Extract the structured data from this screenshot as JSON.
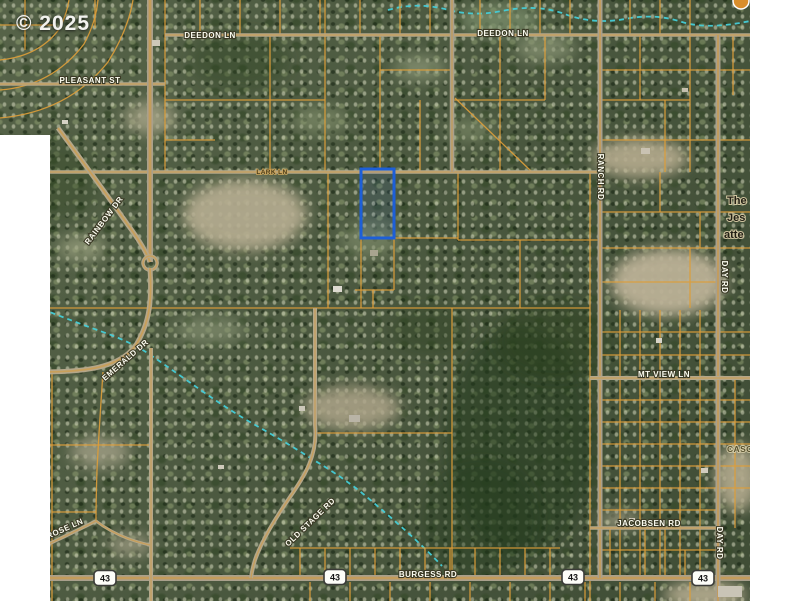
{
  "copyright": "© 2025",
  "map": {
    "palette": {
      "parcel_line": "#dc9d3a",
      "road_casing_tan": "#b4a78a",
      "road_casing_gray": "#a9a08c",
      "road_core_orange": "#d59a3a",
      "creek": "#45cdd8",
      "highlight_blue": "#1d5fd8",
      "label_white": "#fcfcf0",
      "white_margin": "#ffffff"
    },
    "parcel_highlight": {
      "x": 361,
      "y": 169,
      "w": 33,
      "h": 69
    },
    "badge": {
      "cx": 741,
      "cy": 1,
      "r": 8,
      "fill": "#d98e2c"
    },
    "roads_major": [
      {
        "name": "deedon-ln-road",
        "d": "M165,35 H750",
        "w": 3.5
      },
      {
        "name": "pleasant-st-road",
        "d": "M0,84 H165",
        "w": 3.5
      },
      {
        "name": "lark-ln-road",
        "d": "M40,172 H600",
        "w": 3.5
      },
      {
        "name": "burgess-rd-road",
        "d": "M40,578 H750",
        "w": 6,
        "g": 1
      },
      {
        "name": "ranch-rd-road",
        "d": "M600,0 V578",
        "w": 5,
        "g": 1
      },
      {
        "name": "day-rd-road",
        "d": "M718,35 V601",
        "w": 5,
        "g": 1
      },
      {
        "name": "west-vertical-road",
        "d": "M150,0 V262",
        "w": 6,
        "g": 1
      },
      {
        "name": "north-vertical-road",
        "d": "M452,0 V172",
        "w": 4.5,
        "g": 1
      },
      {
        "name": "mt-view-ln-road",
        "d": "M590,378 H750",
        "w": 4
      },
      {
        "name": "jacobsen-rd-road",
        "d": "M590,528 H718",
        "w": 3.5
      },
      {
        "name": "rainbow-dr-road",
        "d": "M58,128 Q100,185 128,225 Q145,248 150,262",
        "w": 5
      },
      {
        "name": "roundabout",
        "d": "M150,256 a7,7 0 1,0 0.1,0",
        "w": 3.5
      },
      {
        "name": "emerald-dr-road",
        "d": "M150,268 C152,300 150,322 136,345 C120,368 85,372 40,372",
        "w": 5
      },
      {
        "name": "south-vertical-road",
        "d": "M151,348 V601",
        "w": 4
      },
      {
        "name": "old-stage-rd-road",
        "d": "M315,308 V425 C318,455 305,475 290,497 C275,519 262,540 255,560 Q252,570 251,578",
        "w": 4
      },
      {
        "name": "rose-ln-road",
        "d": "M40,548 Q70,534 96,521",
        "w": 3.5
      },
      {
        "name": "rose-ln-east-road",
        "d": "M96,521 Q118,538 150,545",
        "w": 3
      }
    ],
    "parcel_lines": [
      "M200,0 V35",
      "M240,0 V35",
      "M280,0 V35",
      "M320,0 V35",
      "M360,0 V35",
      "M400,0 V35",
      "M430,0 V35",
      "M480,0 V35",
      "M510,0 V35",
      "M540,0 V35",
      "M570,0 V35",
      "M630,0 V35",
      "M660,0 V35",
      "M690,0 V35",
      "M25,0 V50",
      "M0,25 H55",
      "M95,0 V28",
      "M0,118 Q68,112 108,62 Q128,30 133,0",
      "M0,90 Q52,86 84,44 Q96,22 98,0",
      "M0,60 Q40,56 60,28 Q67,13 69,0",
      "M165,0 V172",
      "M270,35 V172",
      "M325,0 V172",
      "M380,35 V172",
      "M420,100 V172",
      "M500,35 V172",
      "M545,35 V100",
      "M640,35 V100",
      "M665,100 V172",
      "M690,35 V172",
      "M733,35 V95",
      "M165,100 H325",
      "M165,140 H215",
      "M380,70 H452",
      "M452,100 H545",
      "M600,70 H750",
      "M600,100 H690",
      "M600,140 H750",
      "M455,98 L532,172",
      "M328,172 V308",
      "M361,172 V308",
      "M394,172 V290",
      "M458,172 V240",
      "M520,240 V308",
      "M373,290 V308",
      "M590,172 V601",
      "M355,290 H394",
      "M394,238 H458",
      "M458,240 H600",
      "M40,308 H590",
      "M600,212 H750",
      "M600,248 H750",
      "M600,282 H718",
      "M660,172 V212",
      "M700,212 V248",
      "M690,248 V308",
      "M52,372 V601",
      "M50,445 H152",
      "M52,512 H96",
      "M103,372 Q99,430 97,470 Q96,500 96,521",
      "M452,308 V578",
      "M315,433 H452",
      "M620,310 V578",
      "M640,310 V578",
      "M660,310 V578",
      "M680,310 V578",
      "M700,310 V578",
      "M735,378 V528",
      "M600,332 H750",
      "M600,355 H750",
      "M600,400 H750",
      "M600,422 H750",
      "M600,444 H750",
      "M600,466 H750",
      "M600,488 H750",
      "M600,510 H718",
      "M600,550 H718",
      "M610,528 V578",
      "M645,528 V578",
      "M665,528 V578",
      "M685,550 V578",
      "M290,548 H560",
      "M300,548 V578",
      "M325,548 V578",
      "M350,548 V578",
      "M375,548 V578",
      "M400,548 V578",
      "M425,548 V578",
      "M450,548 V578",
      "M475,548 V578",
      "M500,548 V578",
      "M525,548 V578",
      "M550,548 V578",
      "M310,582 V601",
      "M350,582 V601",
      "M390,582 V601",
      "M430,582 V601",
      "M470,582 V601",
      "M510,582 V601",
      "M550,582 V601",
      "M585,582 V601",
      "M620,582 V601",
      "M655,582 V601",
      "M690,582 V601"
    ],
    "creeks": [
      "M388,10 Q415,2 445,9 Q472,17 502,11 Q535,4 562,13 Q592,25 625,19 Q655,13 682,22 Q708,30 750,21",
      "M42,309 Q75,322 100,331 Q132,342 152,356 Q178,374 202,391 Q232,412 257,426 Q287,443 312,459 Q341,476 362,493 Q386,513 406,531 Q428,551 442,566"
    ],
    "clearings": [
      {
        "cx": 245,
        "cy": 215,
        "rx": 62,
        "ry": 36,
        "f": "#b7ae92",
        "o": 0.9
      },
      {
        "cx": 150,
        "cy": 118,
        "rx": 26,
        "ry": 16,
        "f": "#a9a689",
        "o": 0.8
      },
      {
        "cx": 640,
        "cy": 158,
        "rx": 48,
        "ry": 20,
        "f": "#b5ab8e",
        "o": 0.9
      },
      {
        "cx": 668,
        "cy": 282,
        "rx": 58,
        "ry": 34,
        "f": "#bbb196",
        "o": 0.95
      },
      {
        "cx": 352,
        "cy": 408,
        "rx": 48,
        "ry": 22,
        "f": "#ada489",
        "o": 0.85
      },
      {
        "cx": 100,
        "cy": 452,
        "rx": 30,
        "ry": 16,
        "f": "#a3a087",
        "o": 0.8
      },
      {
        "cx": 545,
        "cy": 48,
        "rx": 30,
        "ry": 14,
        "f": "#8f9a79",
        "o": 0.7
      },
      {
        "cx": 420,
        "cy": 68,
        "rx": 26,
        "ry": 13,
        "f": "#8f9a79",
        "o": 0.7
      },
      {
        "cx": 737,
        "cy": 478,
        "rx": 22,
        "ry": 34,
        "f": "#b3aa8e",
        "o": 0.9
      },
      {
        "cx": 705,
        "cy": 595,
        "rx": 42,
        "ry": 14,
        "f": "#b7ae92",
        "o": 0.9
      },
      {
        "cx": 82,
        "cy": 248,
        "rx": 24,
        "ry": 13,
        "f": "#9aa07f",
        "o": 0.75
      },
      {
        "cx": 500,
        "cy": 20,
        "rx": 40,
        "ry": 16,
        "f": "#7f9370",
        "o": 0.7
      },
      {
        "cx": 210,
        "cy": 330,
        "rx": 35,
        "ry": 14,
        "f": "#8d9878",
        "o": 0.6
      },
      {
        "cx": 370,
        "cy": 240,
        "rx": 30,
        "ry": 18,
        "f": "#85926f",
        "o": 0.6
      },
      {
        "cx": 620,
        "cy": 520,
        "rx": 20,
        "ry": 10,
        "f": "#a8a289",
        "o": 0.7
      },
      {
        "cx": 130,
        "cy": 545,
        "rx": 22,
        "ry": 12,
        "f": "#a5a188",
        "o": 0.7
      },
      {
        "cx": 320,
        "cy": 120,
        "rx": 28,
        "ry": 14,
        "f": "#87946f",
        "o": 0.6
      },
      {
        "cx": 470,
        "cy": 130,
        "rx": 25,
        "ry": 12,
        "f": "#87946f",
        "o": 0.55
      }
    ],
    "dark_patches": [
      {
        "cx": 520,
        "cy": 440,
        "rx": 75,
        "ry": 115,
        "f": "#243a1e",
        "o": 0.5
      },
      {
        "cx": 555,
        "cy": 340,
        "rx": 60,
        "ry": 40,
        "f": "#2a401f",
        "o": 0.45
      },
      {
        "cx": 480,
        "cy": 520,
        "rx": 60,
        "ry": 60,
        "f": "#243a1e",
        "o": 0.4
      },
      {
        "cx": 240,
        "cy": 60,
        "rx": 50,
        "ry": 30,
        "f": "#2e4424",
        "o": 0.4
      },
      {
        "cx": 60,
        "cy": 180,
        "rx": 40,
        "ry": 40,
        "f": "#2e4424",
        "o": 0.35
      },
      {
        "cx": 430,
        "cy": 330,
        "rx": 40,
        "ry": 25,
        "f": "#2a401f",
        "o": 0.35
      }
    ],
    "buildings": [
      {
        "x": 333,
        "y": 286,
        "w": 9,
        "h": 6,
        "f": "#dddad0"
      },
      {
        "x": 299,
        "y": 406,
        "w": 6,
        "h": 5,
        "f": "#ccc8ba"
      },
      {
        "x": 349,
        "y": 415,
        "w": 11,
        "h": 7,
        "f": "#b9b4a6"
      },
      {
        "x": 218,
        "y": 465,
        "w": 6,
        "h": 4,
        "f": "#cfcabb"
      },
      {
        "x": 641,
        "y": 148,
        "w": 9,
        "h": 6,
        "f": "#c9c2b2"
      },
      {
        "x": 656,
        "y": 338,
        "w": 6,
        "h": 5,
        "f": "#d8d4c8"
      },
      {
        "x": 701,
        "y": 468,
        "w": 7,
        "h": 5,
        "f": "#d2cdbf"
      },
      {
        "x": 629,
        "y": 518,
        "w": 6,
        "h": 4,
        "f": "#cfc9ba"
      },
      {
        "x": 682,
        "y": 88,
        "w": 6,
        "h": 4,
        "f": "#c5bfae"
      },
      {
        "x": 718,
        "y": 586,
        "w": 24,
        "h": 11,
        "f": "#c9c4b6"
      },
      {
        "x": 370,
        "y": 250,
        "w": 8,
        "h": 6,
        "f": "#a8a48f"
      },
      {
        "x": 152,
        "y": 40,
        "w": 8,
        "h": 6,
        "f": "#cdc7b8"
      },
      {
        "x": 62,
        "y": 120,
        "w": 6,
        "h": 4,
        "f": "#d6d2c4"
      }
    ],
    "labels": [
      {
        "t": "DEEDON LN",
        "x": 210,
        "y": 38,
        "r": 0,
        "cls": "road",
        "a": "middle"
      },
      {
        "t": "DEEDON LN",
        "x": 503,
        "y": 36,
        "r": 0,
        "cls": "road",
        "a": "middle"
      },
      {
        "t": "PLEASANT ST",
        "x": 90,
        "y": 83,
        "r": 0,
        "cls": "road",
        "a": "middle"
      },
      {
        "t": "RAINBOW DR",
        "x": 106,
        "y": 222,
        "r": -53,
        "cls": "road",
        "a": "middle"
      },
      {
        "t": "EMERALD DR",
        "x": 127,
        "y": 362,
        "r": -41,
        "cls": "road",
        "a": "middle"
      },
      {
        "t": "ROSE LN",
        "x": 66,
        "y": 531,
        "r": -24,
        "cls": "road",
        "a": "middle"
      },
      {
        "t": "OLD STAGE RD",
        "x": 312,
        "y": 524,
        "r": -44,
        "cls": "road",
        "a": "middle"
      },
      {
        "t": "RANCH RD",
        "x": 598,
        "y": 177,
        "r": 90,
        "cls": "road",
        "a": "middle"
      },
      {
        "t": "DAY RD",
        "x": 722,
        "y": 277,
        "r": 90,
        "cls": "road",
        "a": "middle"
      },
      {
        "t": "DAY RD",
        "x": 717,
        "y": 543,
        "r": 90,
        "cls": "road",
        "a": "middle"
      },
      {
        "t": "MT VIEW LN",
        "x": 664,
        "y": 377,
        "r": 0,
        "cls": "road",
        "a": "middle"
      },
      {
        "t": "JACOBSEN RD",
        "x": 649,
        "y": 526,
        "r": 0,
        "cls": "road",
        "a": "middle"
      },
      {
        "t": "BURGESS RD",
        "x": 428,
        "y": 577,
        "r": 0,
        "cls": "road",
        "a": "middle"
      },
      {
        "t": "LARK LN",
        "x": 272,
        "y": 174,
        "r": 0,
        "cls": "dark",
        "a": "middle"
      },
      {
        "t": "The",
        "x": 727,
        "y": 204,
        "r": 0,
        "cls": "church",
        "a": "start"
      },
      {
        "t": "Jes",
        "x": 727,
        "y": 221,
        "r": 0,
        "cls": "church",
        "a": "start"
      },
      {
        "t": "atte",
        "x": 724,
        "y": 238,
        "r": 0,
        "cls": "church",
        "a": "start"
      },
      {
        "t": "CASC",
        "x": 727,
        "y": 452,
        "r": 0,
        "cls": "casc",
        "a": "start"
      }
    ],
    "shields": [
      {
        "num": "43",
        "x": 105,
        "y": 578
      },
      {
        "num": "43",
        "x": 335,
        "y": 577
      },
      {
        "num": "43",
        "x": 573,
        "y": 577
      },
      {
        "num": "43",
        "x": 703,
        "y": 578
      }
    ]
  }
}
